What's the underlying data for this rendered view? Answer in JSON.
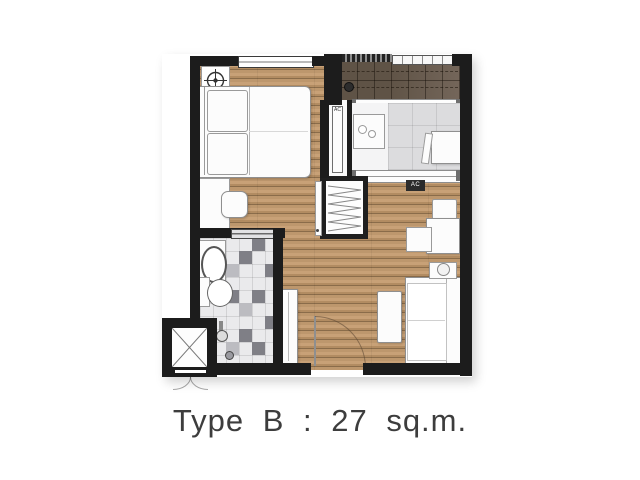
{
  "caption": {
    "text": "Type B : 27 sq.m."
  },
  "unit": {
    "type_name": "Type B",
    "area": "27 sq.m."
  },
  "labels": {
    "ac_niche": "AC",
    "ac_living": "AC"
  },
  "colors": {
    "wall": "#1c1c1c",
    "wood_floor": "#bd976d",
    "balcony_tile": "#5f5346",
    "gray_floor": "#dcdcde",
    "bath_tile_dark": "#7f7f86",
    "bath_tile_base": "#eaeaec",
    "furniture": "#fcfcfc",
    "caption_text": "#3d3d3d"
  },
  "icons": {
    "ceiling_fan": "crosshair-circle",
    "shaft": "x-cross",
    "floor_drain": "dark-circle",
    "hanging_clothes": "zigzag-lines"
  }
}
